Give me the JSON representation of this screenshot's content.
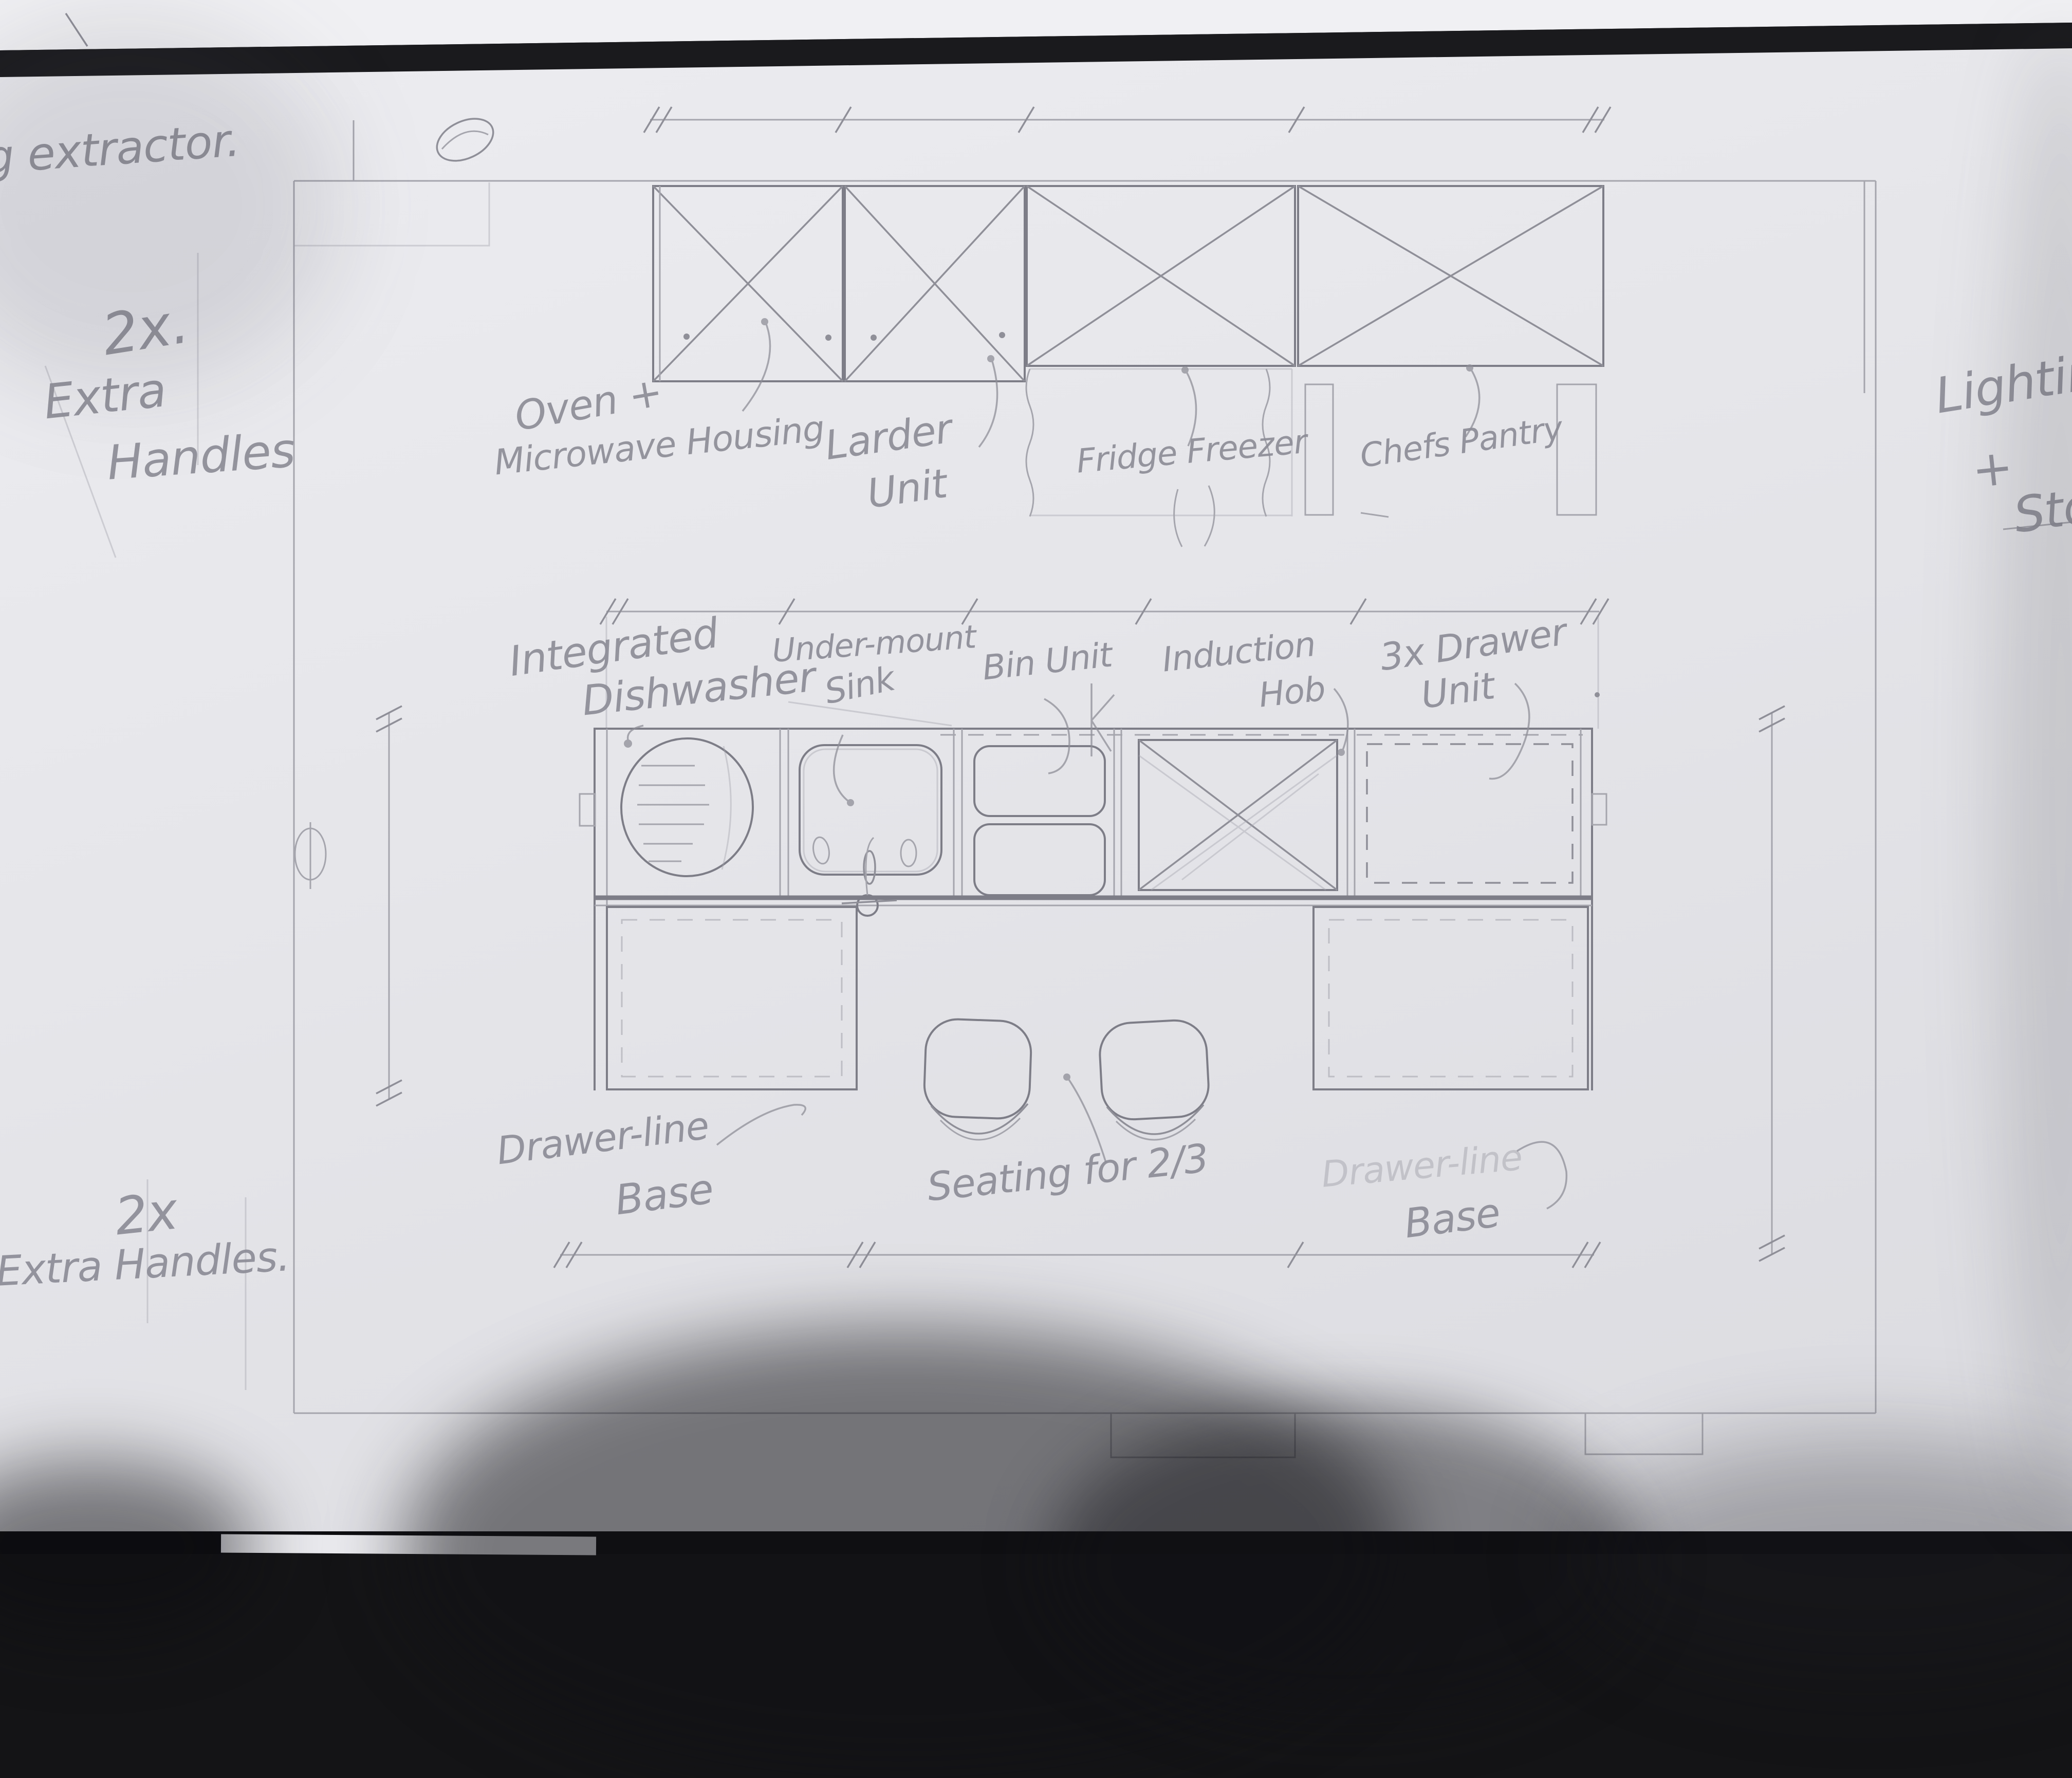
{
  "photo": {
    "paper_color": "#e5e5e9",
    "pencil_color": "#8a8a93",
    "background_color": "#141416"
  },
  "notes": {
    "ceiling_extractor": "Ceiling extractor.",
    "extra_handles_top": {
      "qty": "2x.",
      "line1": "Extra",
      "line2": "Handles"
    },
    "lighting_stools": {
      "line1": "Lighting",
      "line2": "+",
      "line3": "Stools"
    },
    "extra_handles_bottom": {
      "qty": "2x",
      "text": "Extra Handles."
    }
  },
  "wall_units": {
    "oven_line1": "Oven +",
    "oven_line2": "Microwave Housing",
    "larder_line1": "Larder",
    "larder_line2": "Unit",
    "fridge": "Fridge Freezer",
    "pantry": "Chefs Pantry"
  },
  "island": {
    "dishwasher_line1": "Integrated",
    "dishwasher_line2": "Dishwasher",
    "sink_line1": "Under-mount",
    "sink_line2": "Sink",
    "bin": "Bin Unit",
    "hob_line1": "Induction",
    "hob_line2": "Hob",
    "drawers_line1": "3x Drawer",
    "drawers_line2": "Unit"
  },
  "bases": {
    "left_line1": "Drawer-line",
    "left_line2": "Base",
    "seating": "Seating for 2/3",
    "right_line1": "Drawer-line",
    "right_line2": "Base"
  }
}
